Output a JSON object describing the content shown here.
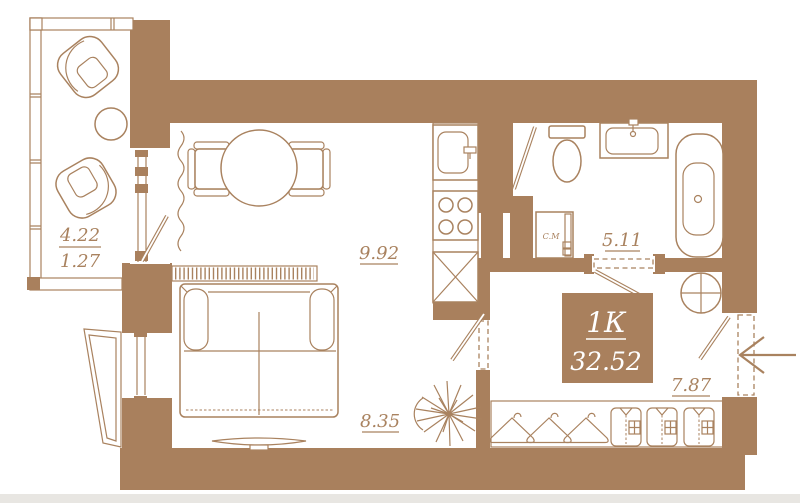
{
  "plan": {
    "unit": {
      "label": "1К",
      "total_area": "32.52"
    },
    "rooms": {
      "balcony": {
        "area": "4.22",
        "area_reduced": "1.27"
      },
      "kitchen_living": {
        "area": "9.92"
      },
      "sleeping_zone": {
        "area": "8.35"
      },
      "bathroom": {
        "area": "5.11"
      },
      "hallway": {
        "area": "7.87"
      }
    },
    "appliances": {
      "washing_machine_label": "С.М"
    },
    "colors": {
      "wall": "#a9805d",
      "line": "#a9825f",
      "background": "#ffffff",
      "page_edge": "#e8e6e2"
    }
  }
}
